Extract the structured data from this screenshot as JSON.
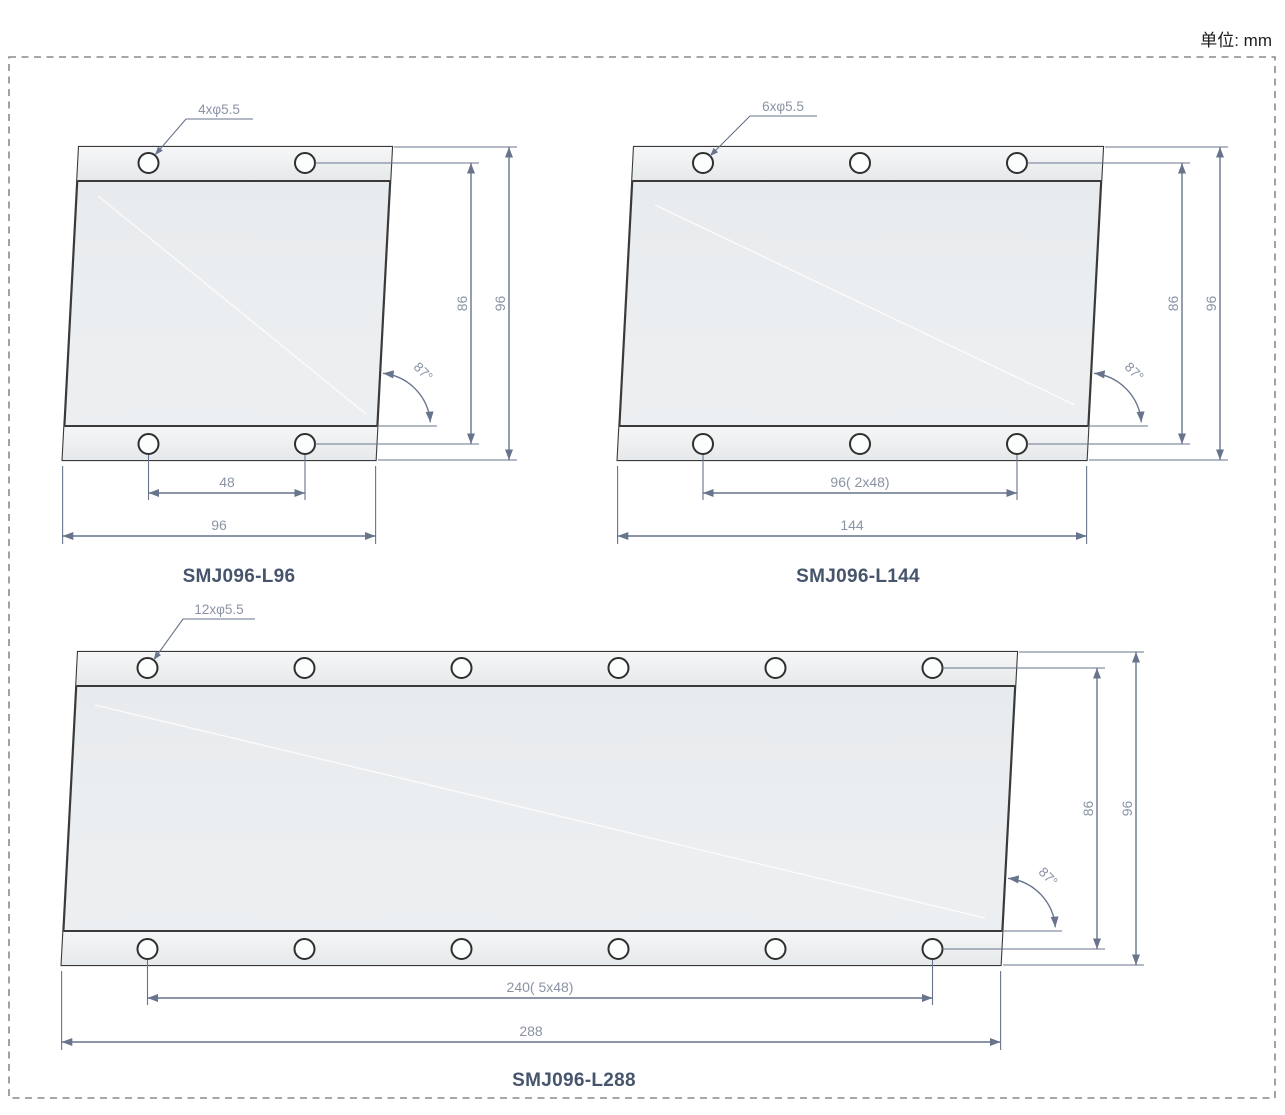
{
  "unit_label": "单位: mm",
  "colors": {
    "dimension": "#67748c",
    "dimension_text": "#8a93a5",
    "model_label": "#46546c",
    "part_outline": "#3a3a3a",
    "part_fill": "#eaedef"
  },
  "drawings": [
    {
      "model": "SMJ096-L96",
      "hole_label": "4xφ5.5",
      "hole_pitch": "48",
      "total_width": "96",
      "hole_row_distance": "86",
      "total_height": "96",
      "angle": "87°"
    },
    {
      "model": "SMJ096-L144",
      "hole_label": "6xφ5.5",
      "hole_pitch": "96( 2x48)",
      "total_width": "144",
      "hole_row_distance": "86",
      "total_height": "96",
      "angle": "87°"
    },
    {
      "model": "SMJ096-L288",
      "hole_label": "12xφ5.5",
      "hole_pitch": "240( 5x48)",
      "total_width": "288",
      "hole_row_distance": "86",
      "total_height": "96",
      "angle": "87°"
    }
  ]
}
